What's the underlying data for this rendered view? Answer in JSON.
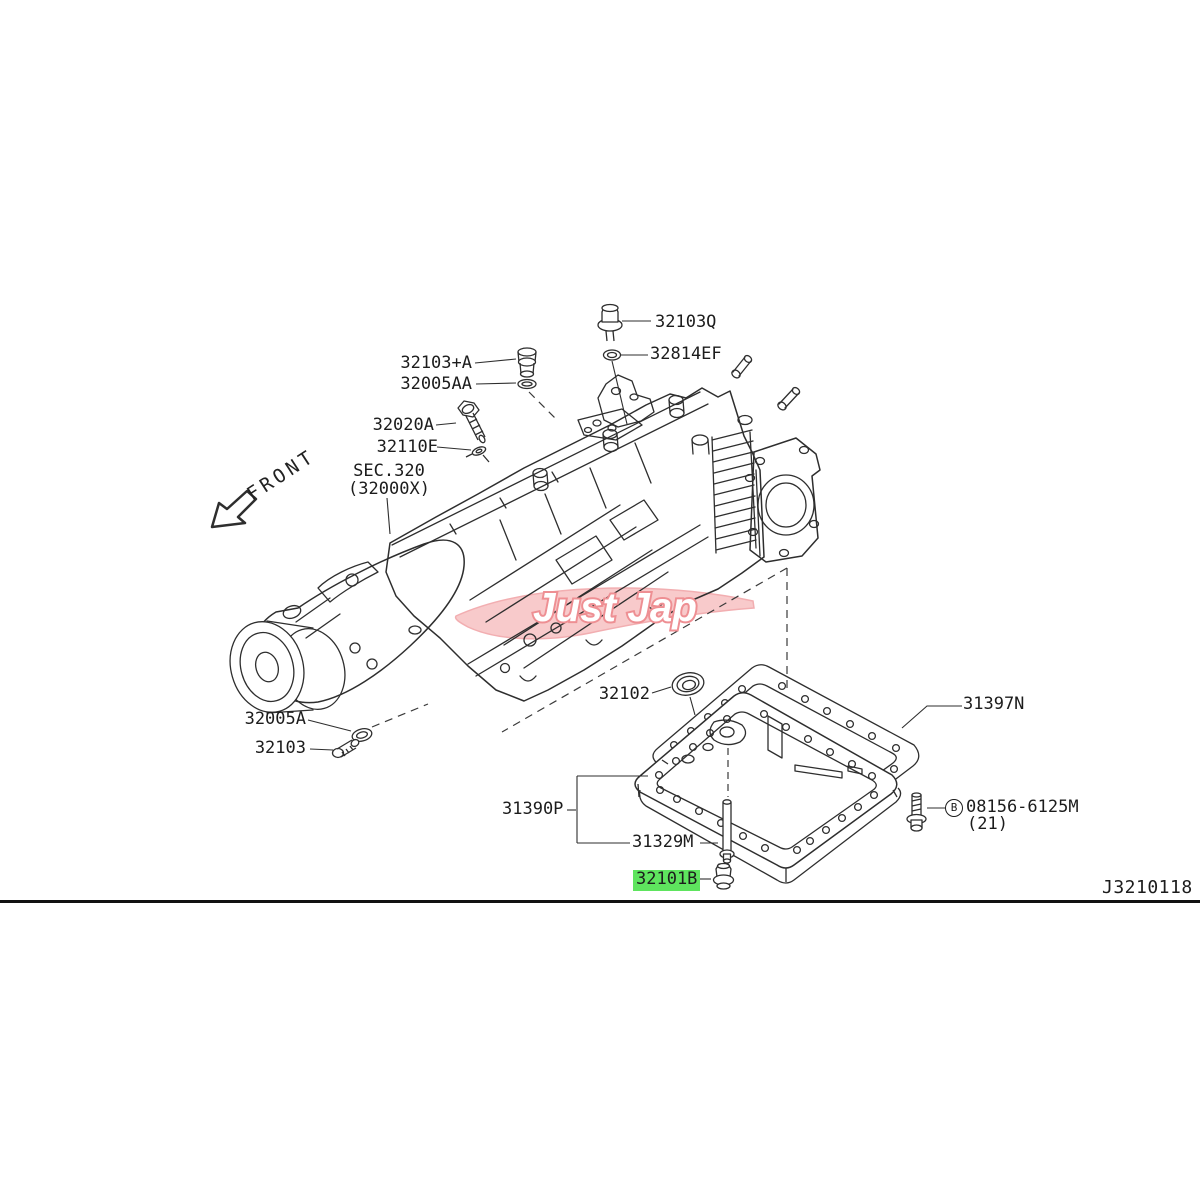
{
  "meta": {
    "drawing_number": "J3210118",
    "front_label": "FRONT",
    "watermark": "Just Jap"
  },
  "section_ref": {
    "line1": "SEC.320",
    "line2": "(32000X)"
  },
  "colors": {
    "line": "#2e2e2e",
    "label_text": "#1c1c1c",
    "highlight_green": "#5ee45e",
    "watermark_pink_fill": "#f7bdbf",
    "watermark_pink_stroke": "#ee8f93"
  },
  "parts": {
    "p32103Q": {
      "label": "32103Q"
    },
    "p32814EF": {
      "label": "32814EF"
    },
    "p32103A": {
      "label": "32103+A"
    },
    "p32005AA": {
      "label": "32005AA"
    },
    "p32020A": {
      "label": "32020A"
    },
    "p32110E": {
      "label": "32110E"
    },
    "p32005A": {
      "label": "32005A"
    },
    "p32103": {
      "label": "32103"
    },
    "p32102": {
      "label": "32102"
    },
    "p31397N": {
      "label": "31397N"
    },
    "p31390P": {
      "label": "31390P"
    },
    "p31329M": {
      "label": "31329M"
    },
    "p32101B": {
      "label": "32101B",
      "highlighted": true
    },
    "p08156": {
      "prefix": "B",
      "label": "08156-6125M",
      "qty": "(21)"
    }
  }
}
